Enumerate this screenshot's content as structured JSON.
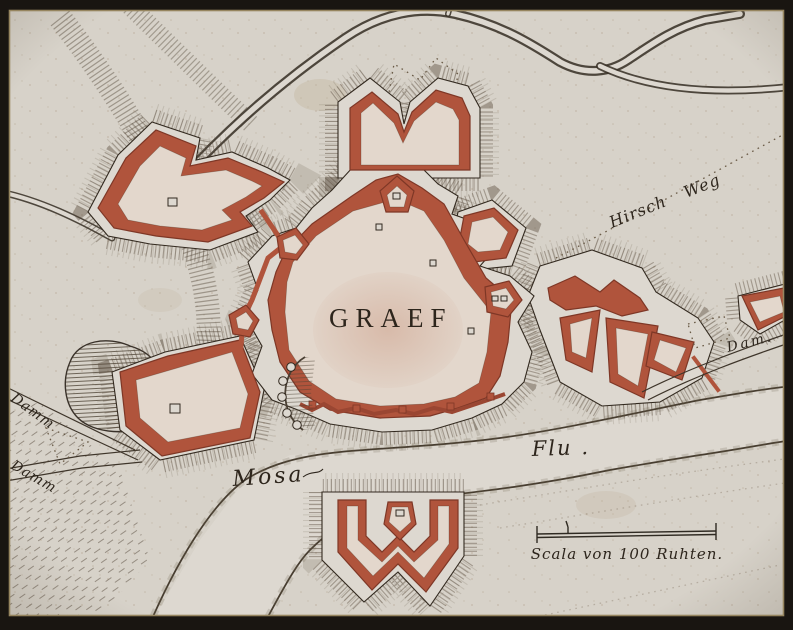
{
  "map": {
    "title": "GRAEF",
    "labels": {
      "hirsch_weg": "Hirsch Weg",
      "dam": "Dam.",
      "damm_upper": "Damm",
      "damm_lower": "Damm",
      "mosa": "Mosa",
      "flu": "Flu .",
      "scale": "Scala von 100 Ruhten."
    },
    "colors": {
      "paper": "#d7d2c9",
      "paper_light": "#ddd8d0",
      "town_fill": "#e3d7cc",
      "red": "#b0543c",
      "red_dark": "#7e3726",
      "ink": "#32291f",
      "hatch": "#554839",
      "border": "#191511",
      "frame_line": "#96855f"
    }
  }
}
